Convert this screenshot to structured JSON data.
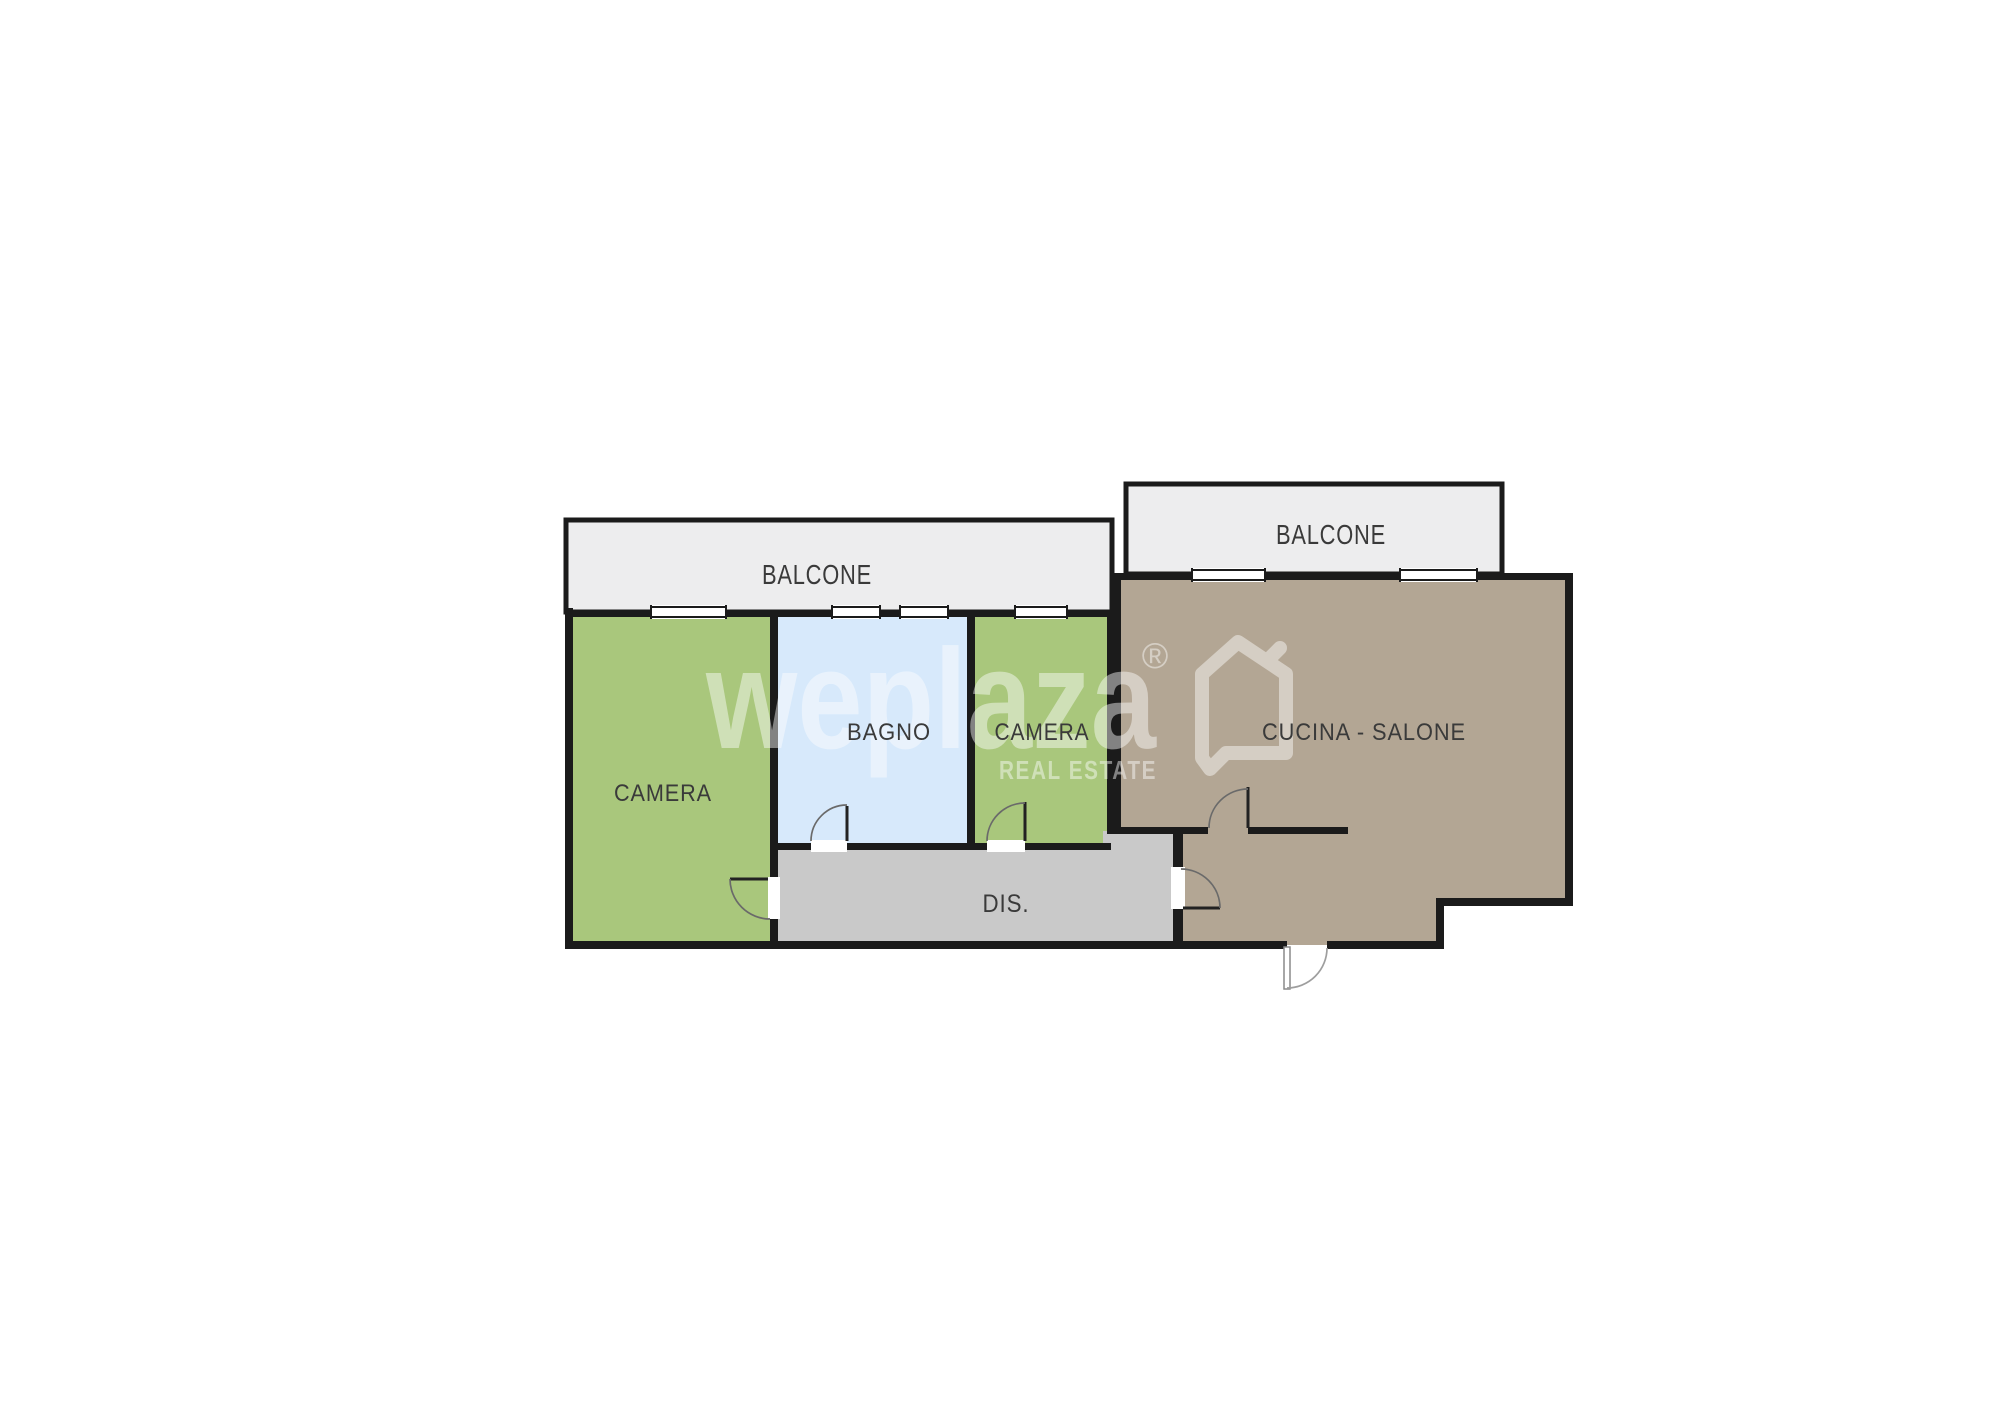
{
  "plan": {
    "background": "#ffffff",
    "wall_color": "#1b1b1b",
    "label_color": "#3a3a3a",
    "rooms": {
      "balcony_left": {
        "label": "BALCONE",
        "color": "#ededee"
      },
      "balcony_right": {
        "label": "BALCONE",
        "color": "#ededee"
      },
      "bedroom_left": {
        "label": "CAMERA",
        "color": "#a9c77c"
      },
      "bathroom": {
        "label": "BAGNO",
        "color": "#d7e9fb"
      },
      "bedroom_middle": {
        "label": "CAMERA",
        "color": "#a9c77c"
      },
      "kitchen_living": {
        "label": "CUCINA - SALONE",
        "color": "#b3a694"
      },
      "hallway": {
        "label": "DIS.",
        "color": "#c9c9c9"
      }
    }
  },
  "watermark": {
    "brand": "weplaza",
    "registered": "®",
    "tagline": "REAL ESTATE",
    "color": "#ffffff"
  }
}
